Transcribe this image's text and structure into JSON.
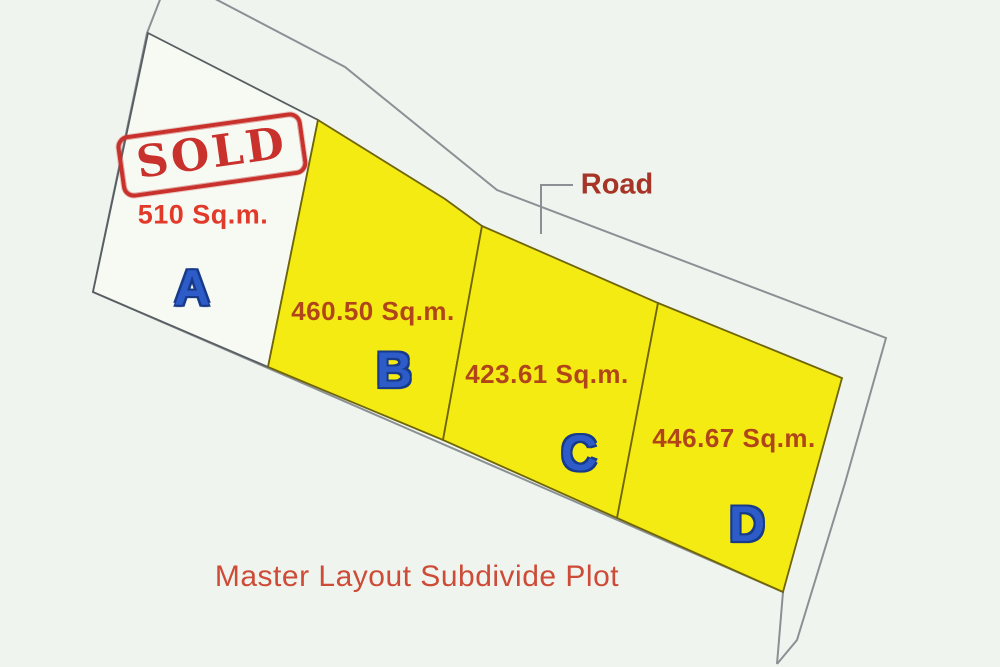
{
  "page": {
    "title": "Master Layout Subdivide Plot",
    "road_label": "Road"
  },
  "stamp": {
    "text": "SOLD"
  },
  "plots": [
    {
      "id": "A",
      "letter": "A",
      "area": "510 Sq.m.",
      "status": "sold",
      "fill": "#f6faf3"
    },
    {
      "id": "B",
      "letter": "B",
      "area": "460.50 Sq.m.",
      "status": "for-sale",
      "fill": "#f4eb12"
    },
    {
      "id": "C",
      "letter": "C",
      "area": "423.61 Sq.m.",
      "status": "for-sale",
      "fill": "#f4eb12"
    },
    {
      "id": "D",
      "letter": "D",
      "area": "446.67 Sq.m.",
      "status": "for-sale",
      "fill": "#f4eb12"
    }
  ],
  "colors": {
    "background": "#eff5ee",
    "plot_yellow": "#f4eb12",
    "plot_yellow_border": "#6f6508",
    "plot_white": "#f6faf3",
    "plot_white_border": "#585d62",
    "boundary_gray": "#8b9094",
    "letter_blue": "#2d5cc8",
    "letter_outline": "#173a8a",
    "stamp_red": "#c8312c",
    "area_text_dark": "#b0451a",
    "area_text_sold": "#e23a2a",
    "road_text": "#a63527",
    "title_text": "#ce4b38"
  }
}
